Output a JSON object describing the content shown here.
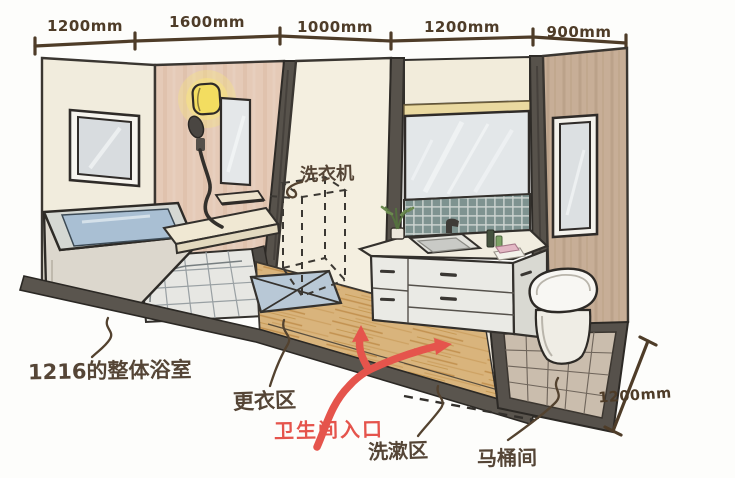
{
  "dimensions": {
    "top": [
      "1200mm",
      "1600mm",
      "1000mm",
      "1200mm",
      "900mm"
    ],
    "right": "1200mm"
  },
  "labels": {
    "washing_machine": "洗衣机",
    "unit_bath": "1216的整体浴室",
    "changing_area": "更衣区",
    "toilet_entrance": "卫生间入口",
    "washing_area": "洗漱区",
    "toilet_room": "马桶间"
  },
  "colors": {
    "dimension_line": "#4e3c28",
    "label_text": "#554536",
    "accent_red": "#e5544c",
    "wood_floor": "#d9b47c",
    "dark_pillar": "#57524b"
  }
}
